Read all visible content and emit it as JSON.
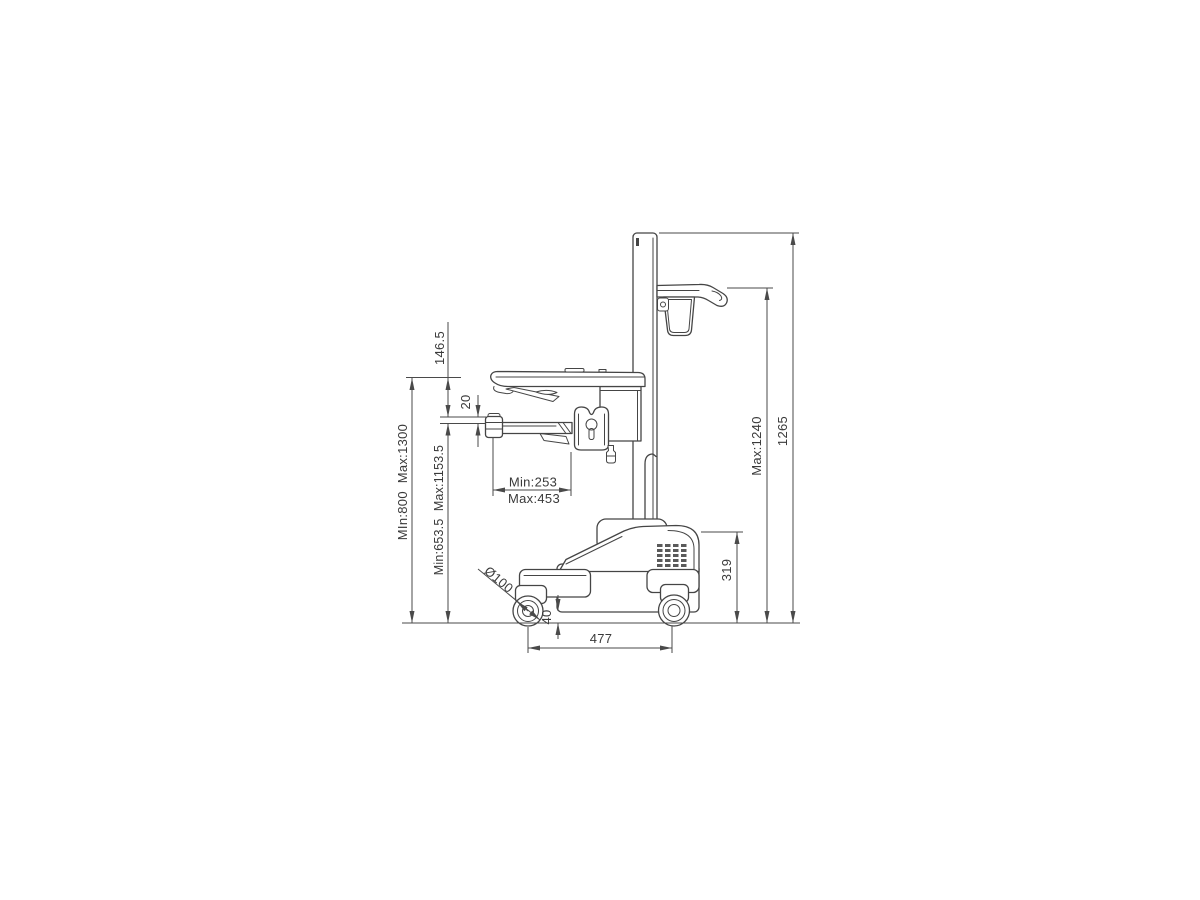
{
  "page": {
    "background": "#ffffff"
  },
  "drawing": {
    "name": "Mobile medical cart side elevation with dimensions",
    "part_line_color": "#454545",
    "dimension_line_color": "#4a4a4a",
    "text_color": "#3a3a3a",
    "dimensions": {
      "overall_height": "1265",
      "accessory_mount_max_height": "Max:1240",
      "base_height": "319",
      "ground_clearance": "40",
      "wheelbase": "477",
      "caster_diameter": "Ø100",
      "worktop_height_range": "MIn:800  Max:1300",
      "keyboard_tray_height_range": "Min:653.5  Max:1153.5",
      "worktop_to_tray_offset": "146.5",
      "tray_step": "20",
      "tray_depth_min": "Min:253",
      "tray_depth_max": "Max:453"
    }
  }
}
